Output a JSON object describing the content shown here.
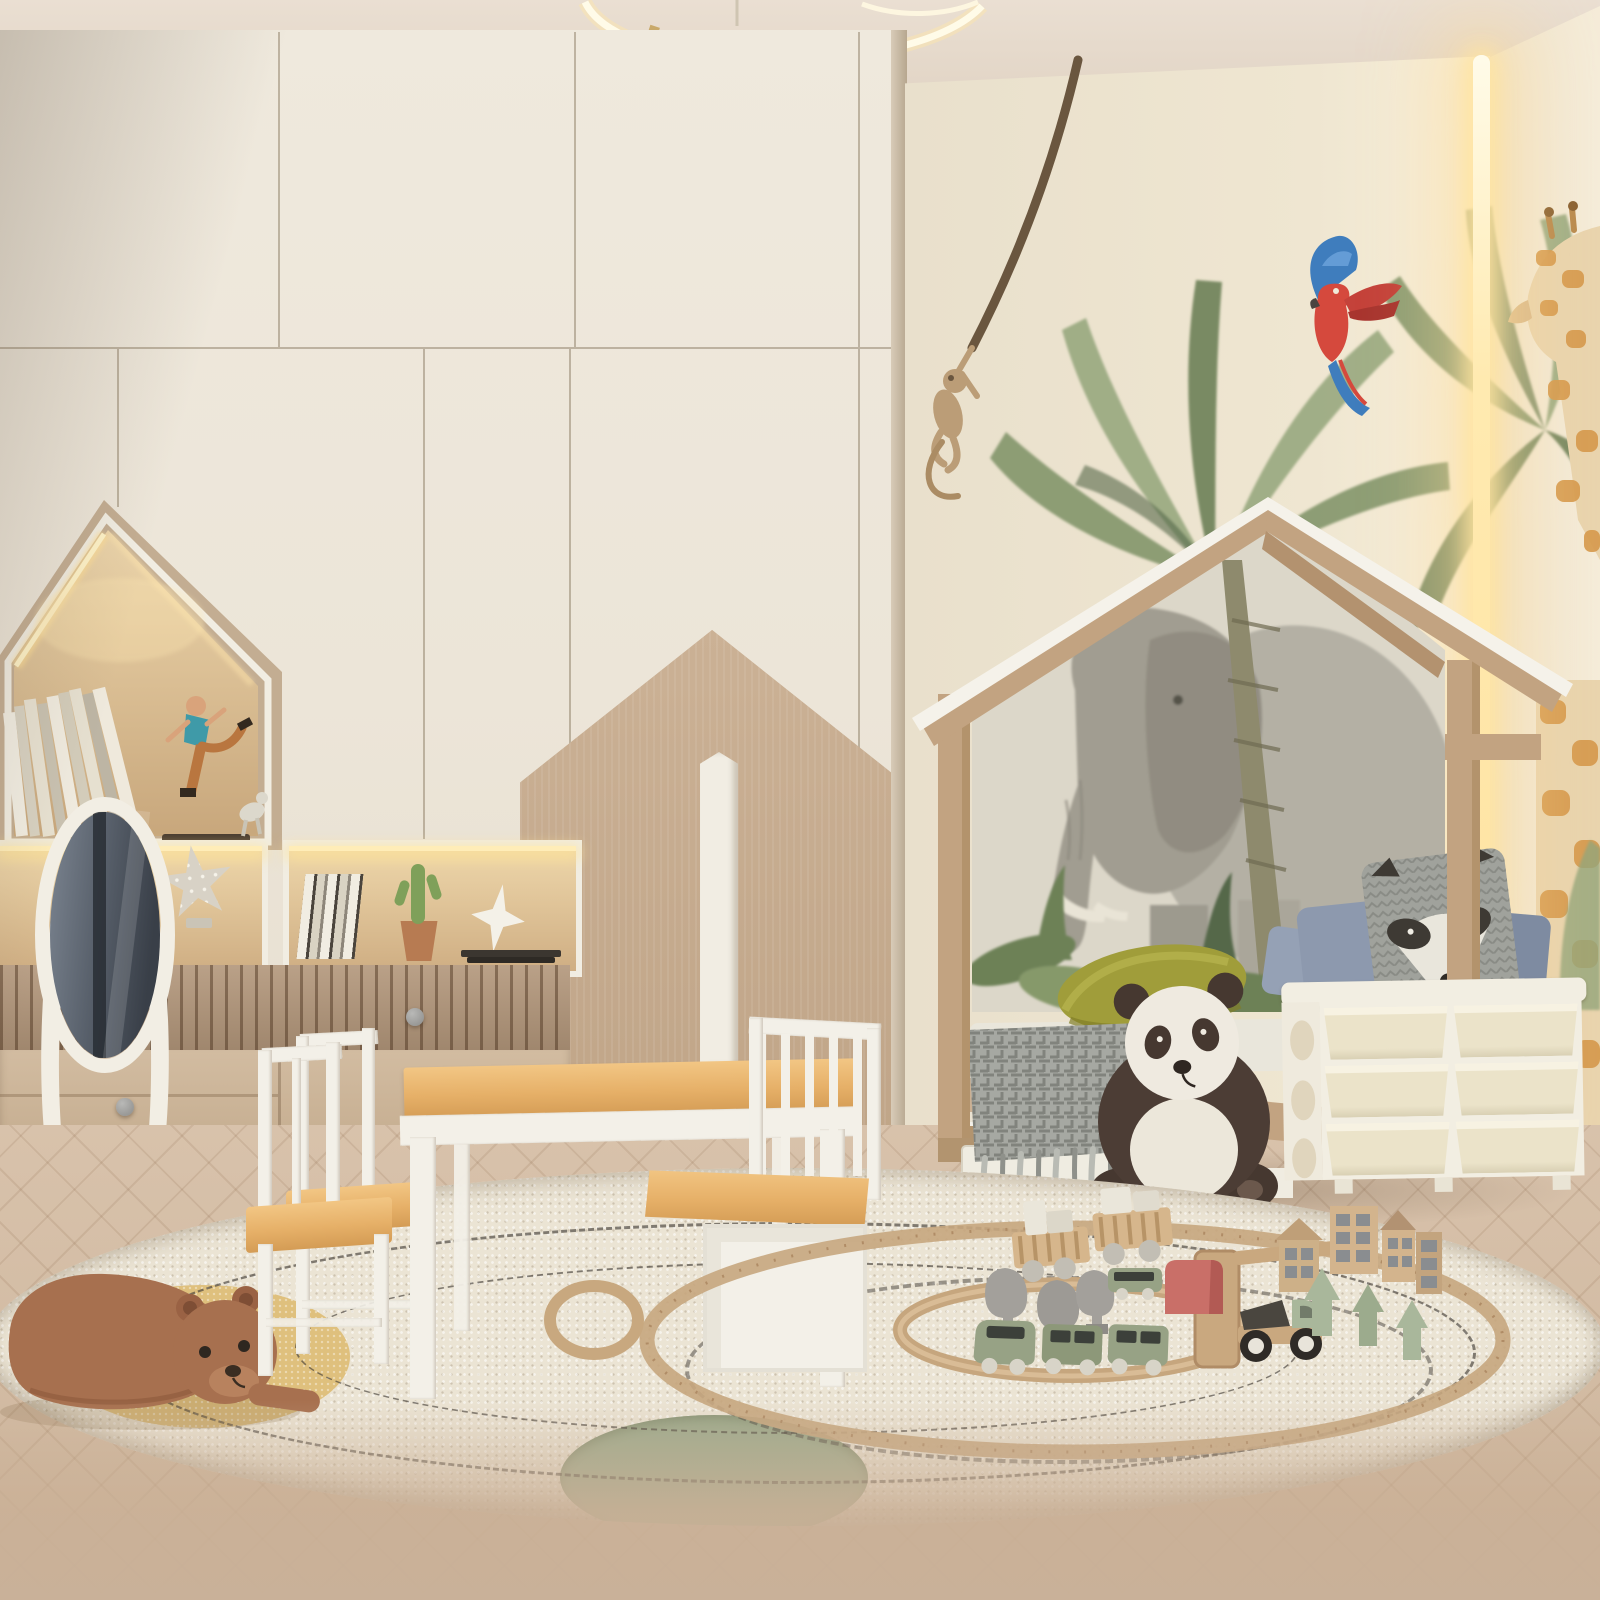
{
  "image_type": "photorealistic 3D interior render (no visible text in image)",
  "room": {
    "name": "children's bedroom playroom",
    "theme": "jungle safari, beige and cream tones",
    "text_content": "none"
  },
  "palette": {
    "ceiling": "#e8ddd0",
    "ceiling-dark": "#d9cbbb",
    "cab-cream": "#eee8dc",
    "wood-tan": "#c6ac8e",
    "slat": "#b2967a",
    "niche-wood": "#ddc49c",
    "led": "#ffe9b0",
    "wall-cream": "#ece3d0",
    "wall-right": "#f3ead6",
    "leaf": "#7d9065",
    "leaf-dark": "#5d7349",
    "leaf-light": "#93a57a",
    "bed-wood": "#c2a381",
    "white-paint": "#f3f0e8",
    "mural-bg": "#dcd7c9",
    "eleph": "#a19d91",
    "eleph-light": "#b4b0a4",
    "pillow-blue": "#8d99ae",
    "banana": "#a09d3a",
    "blanket": "#a6a8a2",
    "panda-dark": "#4c3d35",
    "panda-white": "#efeade",
    "bin-frame": "#f2eee2",
    "bin": "#ebe3c9",
    "rug": "#ebe4d4",
    "rug-stitch": "#46403a",
    "patch-yellow": "#dfc07d",
    "patch-green": "#9cab8d",
    "floor": "#d3bda5",
    "floor-blur": "#c9b199",
    "bear": "#a7704f",
    "table-wood": "#e6b068",
    "track": "#c6a67e",
    "train-green": "#97a285",
    "tree-gray": "#a3a09b",
    "tree-sage": "#a9b79b",
    "toy-red": "#c96f68",
    "house-tan": "#d3b48d",
    "win-gray": "#8a8d90",
    "mirror-glass": "#5d6670",
    "giraffe": "#d69a4e",
    "parrot-red": "#d5493d",
    "parrot-blue": "#3f7dbd",
    "monkey": "#bb9d77",
    "vine": "#6a563f"
  },
  "objects": [
    {
      "name": "ring-pendant-light",
      "details": "thin LED ring lamp partially visible at top center of ceiling"
    },
    {
      "name": "wardrobe-wall",
      "details": "floor-to-ceiling cream handleless wardrobe, left two thirds of room"
    },
    {
      "name": "mountain-decal",
      "details": "tan two-tone mountain graphic on lower wardrobe doors"
    },
    {
      "name": "house-shaped-niche",
      "details": "house silhouette display niche with warm LED strip, leaning books, running-man figurine with dog"
    },
    {
      "name": "display-niche-left",
      "details": "lit shelf niche holding a dotted star lamp"
    },
    {
      "name": "display-niche-right",
      "details": "lit shelf niche with books, potted cactus, white star ornament, stack of dark books"
    },
    {
      "name": "fluted-slat-panel",
      "details": "vertical wood slat band under niches"
    },
    {
      "name": "dresser-drawers",
      "details": "light oak drawer fronts with round gray knobs"
    },
    {
      "name": "standing-oval-mirror",
      "details": "white cheval mirror, crown cutout base, dark glass reflection"
    },
    {
      "name": "accent-pilaster",
      "details": "white pointed vertical trim on wardrobe"
    },
    {
      "name": "jungle-wallpaper",
      "details": "cream wall with watercolor palms, hanging monkey on vine, scarlet macaw, giraffe"
    },
    {
      "name": "corner-led-strip",
      "details": "warm vertical LED line in wall corner"
    },
    {
      "name": "house-frame-bed",
      "details": "wooden montessori house bed, white roof fascia, elephant mural inside"
    },
    {
      "name": "bedding",
      "details": "blue-gray pillows, raccoon face pillow, olive banana cushion, gray patterned fringe blanket, white crib rail, wooden spindle side rail, white under-bed drawer"
    },
    {
      "name": "panda-plush",
      "details": "large seated plush panda, dark brown and cream"
    },
    {
      "name": "plastic-storage-unit",
      "details": "cream plastic chest with six tilt bins in two columns"
    },
    {
      "name": "round-shag-rug",
      "details": "large ivory shag rug with dashed stitch circles, mustard patch and sage patch"
    },
    {
      "name": "bear-plush",
      "details": "terracotta bear plush lying on rug"
    },
    {
      "name": "kids-table",
      "details": "square table, beech top, white legs"
    },
    {
      "name": "kids-chairs",
      "details": "two white chairs with beech seats"
    },
    {
      "name": "storage-bench",
      "details": "white bench with spindle back, beech seat, box base"
    },
    {
      "name": "wooden-train-set",
      "details": "oval track with ramp, green passenger trains, crate cargo train, gray and sage trees, red arch block, green truck, wooden houses, loose track ring"
    },
    {
      "name": "herringbone-floor",
      "details": "pale tan herringbone parquet, blurred in foreground"
    }
  ]
}
